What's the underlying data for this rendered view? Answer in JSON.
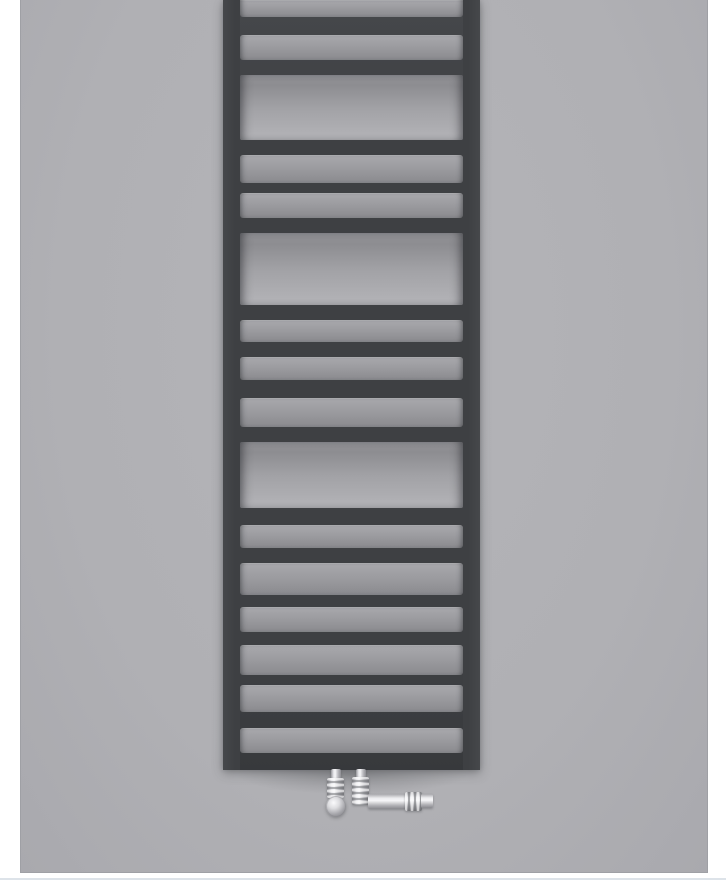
{
  "meta": {
    "type": "product-photo",
    "subject": "anthracite ladder towel radiator with chrome valves",
    "text_content": "none"
  },
  "colors": {
    "page_bg": "#ffffff",
    "photo_bg": "#b0b0b4",
    "photo_bg_highlight": "#b4b4b8",
    "photo_bg_shade": "#a9a9ae",
    "photo_edge": "#9fa0a5",
    "radiator_dark": "#3e4043",
    "radiator_dark_highlight": "#46484b",
    "radiator_dark_shadow": "#37393c",
    "bar_face_top": "#a9a9ad",
    "bar_face_bottom": "#8a8a8e",
    "towel_gap_top": "#909094",
    "towel_gap_bottom": "#b1b1b5",
    "chrome_light": "#f6f6f8",
    "chrome_dark": "#8d8d92",
    "bottom_rule": "#dde3e9"
  },
  "photo": {
    "left": 20,
    "top": 0,
    "width": 688,
    "height": 873
  },
  "bottom_rule": {
    "x": 0,
    "y": 878,
    "width": 726,
    "height": 2
  },
  "radiator": {
    "left": 223,
    "top": 0,
    "width": 257,
    "height": 770,
    "rail_width": 17,
    "bands": [
      {
        "type": "strip",
        "h": 17
      },
      {
        "type": "tube",
        "h": 18
      },
      {
        "type": "strip",
        "h": 25
      },
      {
        "type": "tube",
        "h": 15
      },
      {
        "type": "gap",
        "h": 65
      },
      {
        "type": "tube",
        "h": 15
      },
      {
        "type": "strip",
        "h": 28
      },
      {
        "type": "tube",
        "h": 10
      },
      {
        "type": "strip",
        "h": 25
      },
      {
        "type": "tube",
        "h": 15
      },
      {
        "type": "gap",
        "h": 72
      },
      {
        "type": "tube",
        "h": 15
      },
      {
        "type": "strip",
        "h": 22
      },
      {
        "type": "tube",
        "h": 15
      },
      {
        "type": "strip",
        "h": 23
      },
      {
        "type": "tube",
        "h": 18
      },
      {
        "type": "strip",
        "h": 29
      },
      {
        "type": "tube",
        "h": 15
      },
      {
        "type": "gap",
        "h": 66
      },
      {
        "type": "tube",
        "h": 17
      },
      {
        "type": "strip",
        "h": 23
      },
      {
        "type": "tube",
        "h": 15
      },
      {
        "type": "strip",
        "h": 32
      },
      {
        "type": "tube",
        "h": 12
      },
      {
        "type": "strip",
        "h": 25
      },
      {
        "type": "tube",
        "h": 13
      },
      {
        "type": "strip",
        "h": 30
      },
      {
        "type": "tube",
        "h": 10
      },
      {
        "type": "strip",
        "h": 27
      },
      {
        "type": "tube",
        "h": 16
      },
      {
        "type": "strip",
        "h": 25
      },
      {
        "type": "tube",
        "h": 17
      }
    ]
  },
  "floor_shadow": {
    "x": 238,
    "y": 764,
    "width": 228,
    "height": 30
  },
  "valves": {
    "left": {
      "parts": [
        {
          "name": "valve-left-stem",
          "cls": "chrome-v",
          "x": 331,
          "y": 769,
          "w": 10,
          "h": 11
        },
        {
          "name": "valve-left-body",
          "cls": "chrome-v ridged",
          "x": 327,
          "y": 778,
          "w": 17,
          "h": 20
        },
        {
          "name": "valve-left-knob",
          "cls": "chrome-knob",
          "x": 326,
          "y": 796,
          "w": 20,
          "h": 21
        }
      ]
    },
    "right": {
      "parts": [
        {
          "name": "valve-right-stem",
          "cls": "chrome-v",
          "x": 356,
          "y": 769,
          "w": 10,
          "h": 10
        },
        {
          "name": "valve-right-body",
          "cls": "chrome-v ridged",
          "x": 352,
          "y": 777,
          "w": 17,
          "h": 28
        },
        {
          "name": "valve-right-arm",
          "cls": "chrome-h",
          "x": 368,
          "y": 794,
          "w": 39,
          "h": 15
        },
        {
          "name": "valve-right-nut",
          "cls": "chrome-h ridged",
          "x": 405,
          "y": 792,
          "w": 17,
          "h": 19
        },
        {
          "name": "valve-right-tip",
          "cls": "chrome-h",
          "x": 421,
          "y": 794,
          "w": 12,
          "h": 14
        }
      ]
    }
  }
}
